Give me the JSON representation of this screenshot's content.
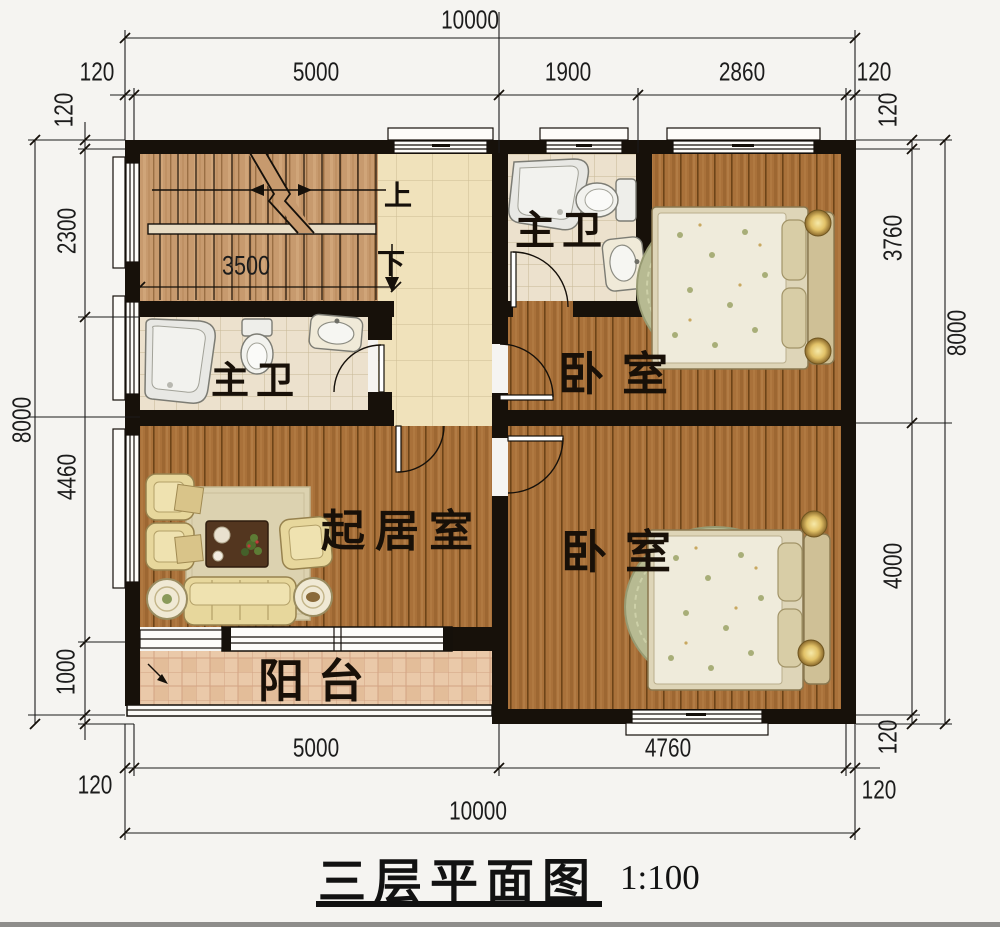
{
  "title": {
    "name": "三层平面图",
    "scale": "1:100"
  },
  "rooms": {
    "bath_top": "主卫",
    "bath_left": "主卫",
    "bed_top": "卧室",
    "bed_bottom": "卧室",
    "living": "起居室",
    "balcony": "阳台"
  },
  "stairs": {
    "up": "上",
    "down": "下",
    "width_dim": "3500"
  },
  "dims": {
    "top_overall": "10000",
    "top_wall_l": "120",
    "top_wall_lv": "120",
    "top_seg1": "5000",
    "top_seg2": "1900",
    "top_seg3": "2860",
    "top_wall_r": "120",
    "top_wall_rv": "120",
    "left_overall": "8000",
    "left_seg1": "2300",
    "left_seg2": "4460",
    "left_seg3": "1000",
    "right_overall": "8000",
    "right_seg1": "3760",
    "right_seg2": "4000",
    "right_wall_bv": "120",
    "bot_seg1": "5000",
    "bot_seg2": "4760",
    "bot_overall": "10000",
    "bot_wall_l": "120",
    "bot_wall_r": "120"
  },
  "colors": {
    "wall": "#17110a",
    "wood": "#a9713a",
    "stair_wood": "#c79a6e",
    "bath_tile": "#ece1cd",
    "corridor_tile": "#f0e2bb",
    "balcony_tile": "#eac9a9",
    "furniture": "#e7d79c",
    "dim_line": "#1c1c1c"
  }
}
